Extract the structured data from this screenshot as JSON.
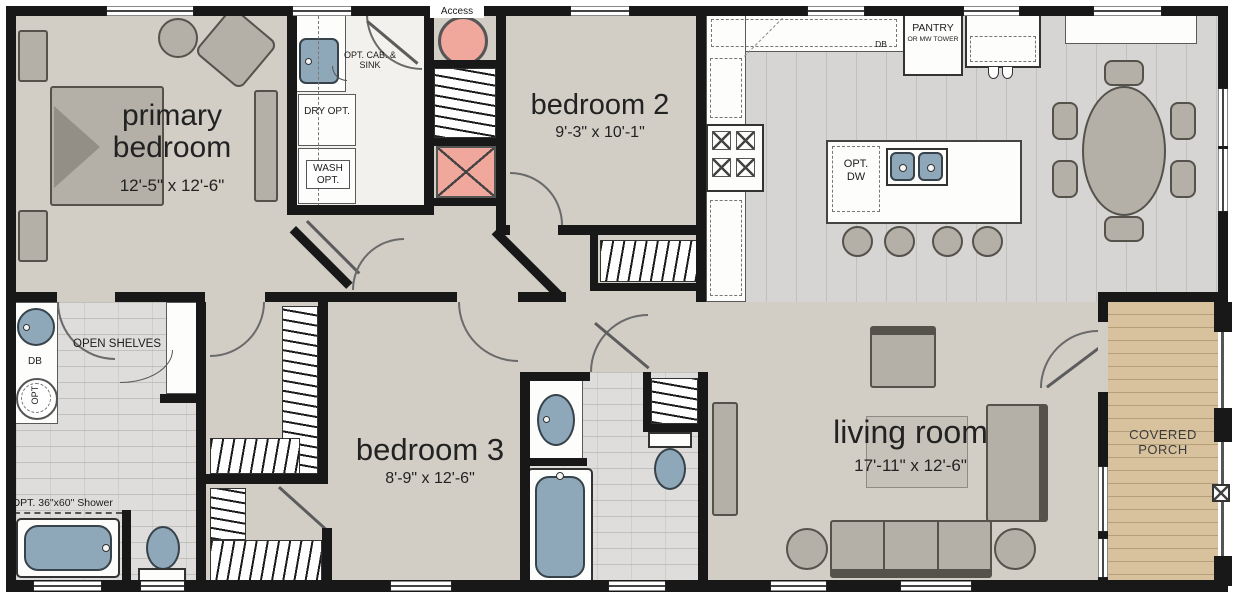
{
  "plan": {
    "type": "floor-plan",
    "rooms": {
      "primary_bedroom": {
        "name": "primary bedroom",
        "dims": "12'-5\" x 12'-6\""
      },
      "bedroom2": {
        "name": "bedroom 2",
        "dims": "9'-3\" x 10'-1\""
      },
      "bedroom3": {
        "name": "bedroom 3",
        "dims": "8'-9\" x 12'-6\""
      },
      "living_room": {
        "name": "living room",
        "dims": "17'-11\" x 12'-6\""
      },
      "covered_porch": {
        "name": "COVERED PORCH"
      }
    },
    "labels": {
      "access": "Access",
      "opt_cab_sink": "OPT. CAB. & SINK",
      "dry_opt": "DRY OPT.",
      "wash_opt": "WASH OPT.",
      "pantry": "PANTRY",
      "pantry_sub": "OR MW TOWER",
      "db_kitchen": "DB",
      "opt_dw": "OPT. DW",
      "open_shelves": "OPEN SHELVES",
      "db_bath": "DB",
      "opt_washer": "OPT",
      "shower_opt": "OPT. 36\"x60\" Shower"
    },
    "colors": {
      "wall": "#181818",
      "floor": "#d2cec6",
      "bath_tile": "#dedddb",
      "kitchen_floor": "#d6d5d3",
      "porch_wood": "#d8c29e",
      "fixture_blue": "#8ea8ba",
      "fixture_pink": "#f0a79c",
      "furniture_gray": "#b4b0a8",
      "counter_white": "#fdfdfc"
    }
  }
}
